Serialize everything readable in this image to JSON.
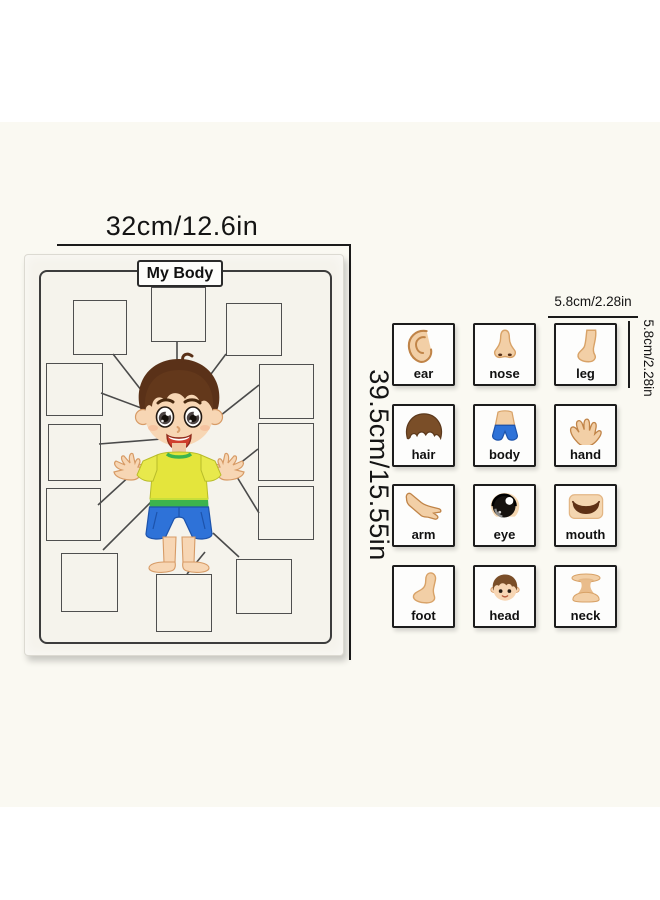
{
  "dimensions": {
    "board_width": "32cm/12.6in",
    "board_height": "39.5cm/15.55in",
    "card_width": "5.8cm/2.28in",
    "card_height": "5.8cm/2.28in"
  },
  "board": {
    "title": "My Body",
    "slot_count": 12
  },
  "cards": [
    {
      "label": "ear",
      "icon": "ear-icon"
    },
    {
      "label": "nose",
      "icon": "nose-icon"
    },
    {
      "label": "leg",
      "icon": "leg-icon"
    },
    {
      "label": "hair",
      "icon": "hair-icon"
    },
    {
      "label": "body",
      "icon": "body-icon"
    },
    {
      "label": "hand",
      "icon": "hand-icon"
    },
    {
      "label": "arm",
      "icon": "arm-icon"
    },
    {
      "label": "eye",
      "icon": "eye-icon"
    },
    {
      "label": "mouth",
      "icon": "mouth-icon"
    },
    {
      "label": "foot",
      "icon": "foot-icon"
    },
    {
      "label": "head",
      "icon": "head-icon"
    },
    {
      "label": "neck",
      "icon": "neck-icon"
    }
  ],
  "colors": {
    "skin": "#f2cfa6",
    "hair_brown": "#5a3118",
    "shirt_yellow": "#e4e53c",
    "trim_green": "#3cb44e",
    "shorts_blue": "#2e72d8",
    "connector_line": "#4a4a4a",
    "card_border": "#1c1c1c",
    "board_paper": "#f5f3ec"
  }
}
